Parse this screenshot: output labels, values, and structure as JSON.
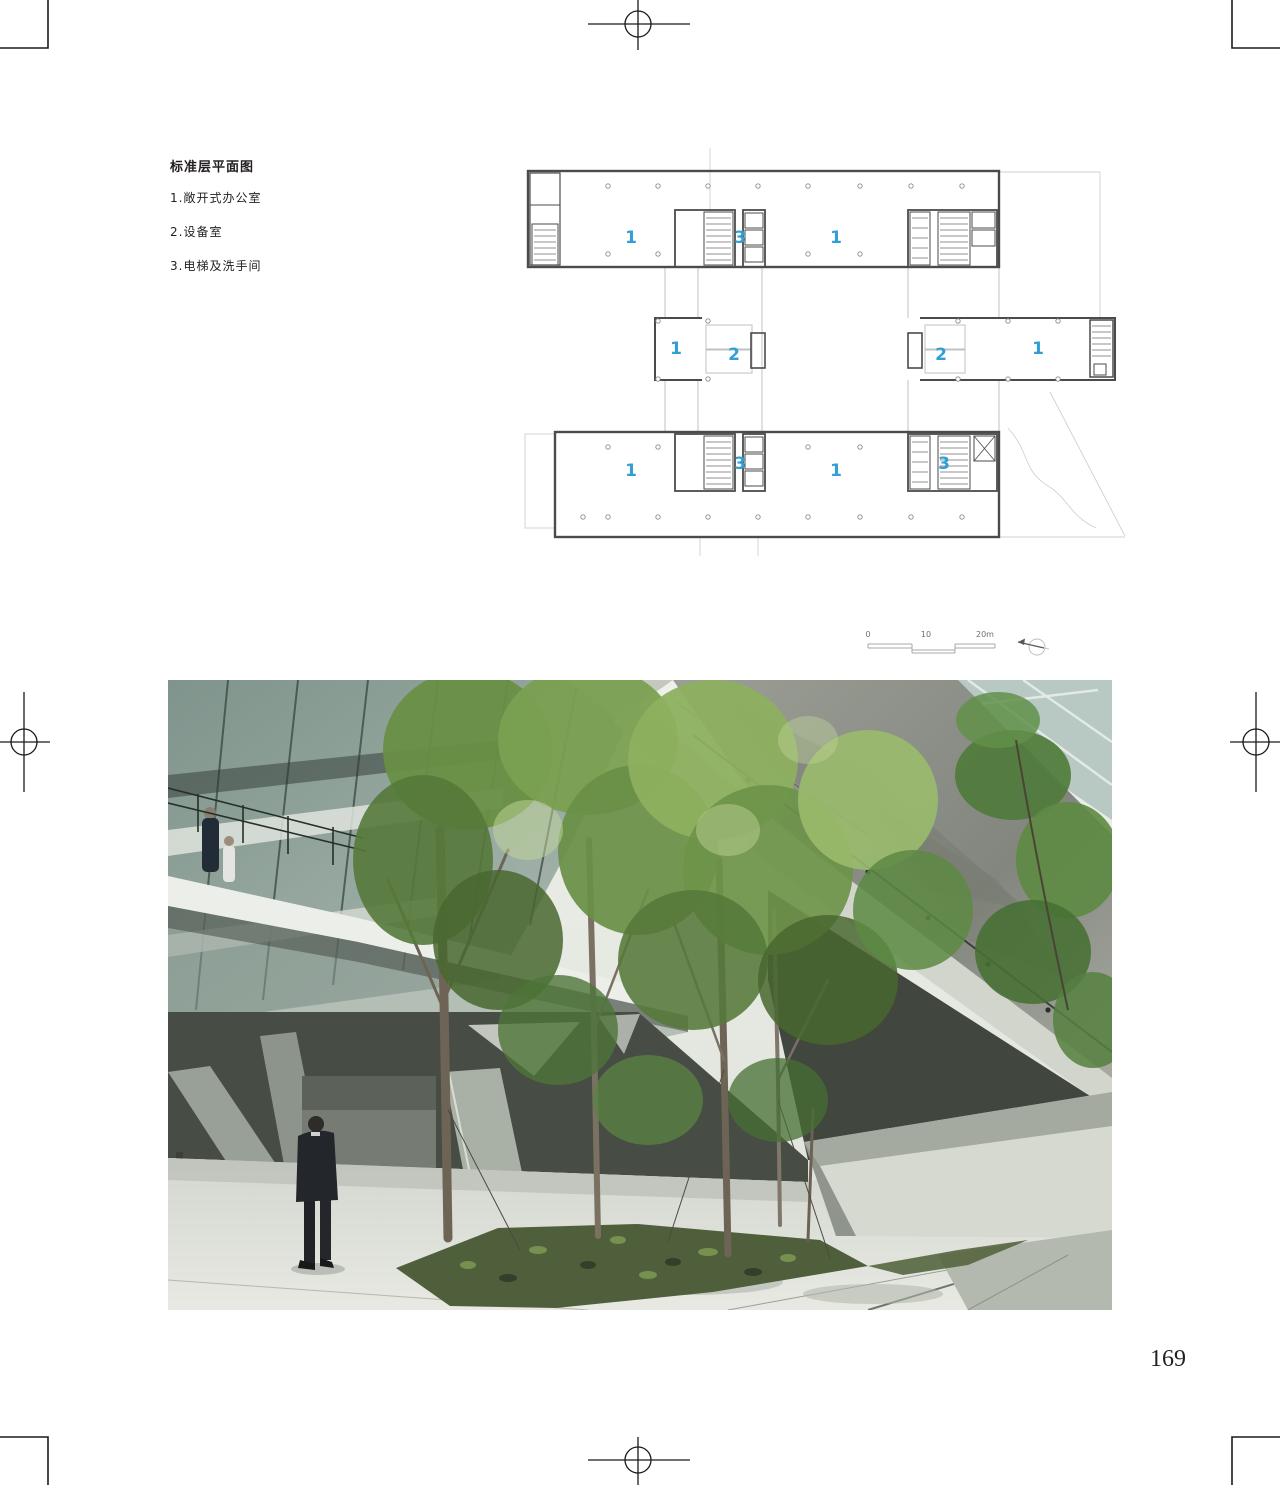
{
  "page": {
    "number": "169"
  },
  "legend": {
    "title": "标准层平面图",
    "items": [
      "1.敞开式办公室",
      "2.设备室",
      "3.电梯及洗手间"
    ]
  },
  "plan": {
    "room_labels": [
      "1",
      "3",
      "1",
      "1",
      "2",
      "2",
      "1",
      "1",
      "3",
      "1",
      "3"
    ],
    "scale_ticks": [
      "0",
      "10",
      "20m"
    ],
    "label_color": "#2f9fd6",
    "wall_color": "#4b4b4d",
    "light_line_color": "#b9bbbd"
  },
  "photo": {
    "alt": "Courtyard with spring trees under a massive raw-concrete cantilevered canopy; glass facade and walkway with two people upper left, man in dark suit standing on bright stone plaza, slanted concrete piers and sunlit inclined wall"
  }
}
